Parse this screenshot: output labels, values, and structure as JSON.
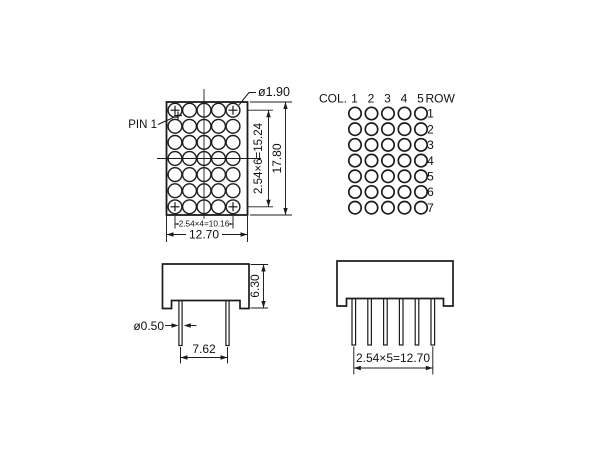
{
  "drawing": {
    "title": "5x7 LED dot matrix display dimensional drawing",
    "colors": {
      "line": "#1c1c1c",
      "background": "#ffffff",
      "text": "#111111"
    },
    "front_view": {
      "pin1_label": "PIN 1",
      "dot_diameter": "ø1.90",
      "dim_row_span": "2.54×6=15.24",
      "dim_height": "17.80",
      "dim_col_span": "2.54×4=10.16",
      "dim_width": "12.70",
      "matrix": {
        "rows": 7,
        "cols": 5
      }
    },
    "pinout": {
      "col_label": "COL.",
      "row_label": "ROW",
      "col_numbers": [
        "1",
        "2",
        "3",
        "4",
        "5"
      ],
      "row_numbers": [
        "1",
        "2",
        "3",
        "4",
        "5",
        "6",
        "7"
      ],
      "matrix": {
        "rows": 7,
        "cols": 5
      }
    },
    "side_view": {
      "dim_body_height": "6.30",
      "pin_diameter": "ø0.50",
      "dim_pin_pitch": "7.62"
    },
    "bottom_view": {
      "dim_pin_span": "2.54×5=12.70"
    }
  }
}
